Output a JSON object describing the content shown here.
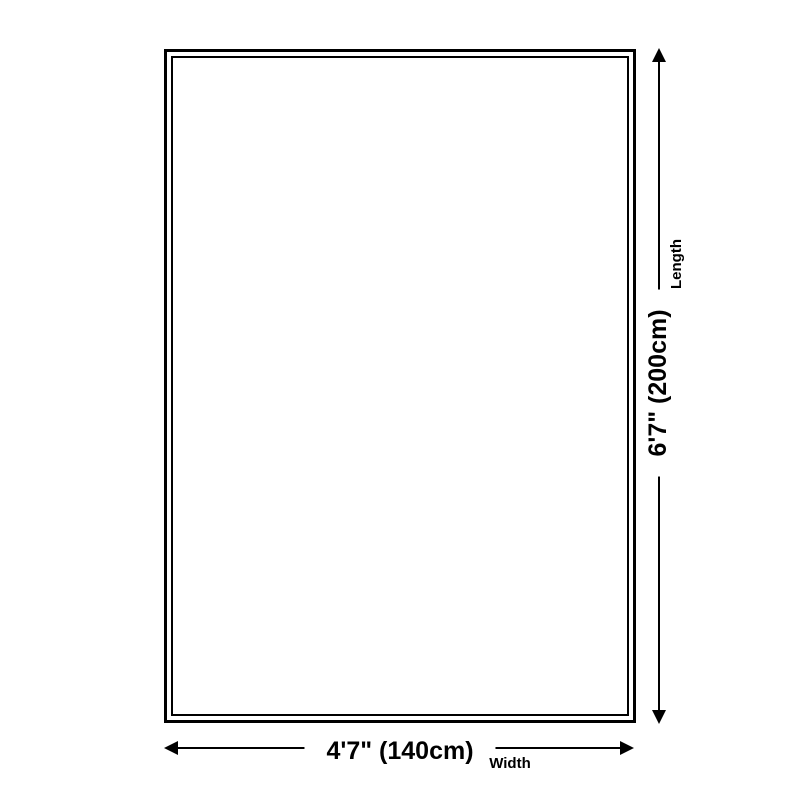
{
  "diagram": {
    "background_color": "#ffffff",
    "line_color": "#000000",
    "product_outline": {
      "outer_border_color": "#000000",
      "inner_border_color": "#000000"
    },
    "width_dimension": {
      "value": "4'7\" (140cm)",
      "label": "Width"
    },
    "length_dimension": {
      "value": "6'7\" (200cm)",
      "label": "Length"
    }
  }
}
